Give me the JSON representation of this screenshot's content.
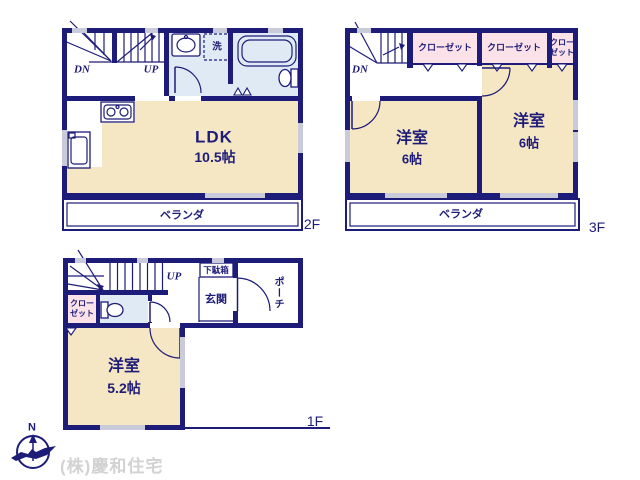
{
  "colors": {
    "wall_navy": "#1d1c78",
    "room_cream": "#f6e7c4",
    "closet_pink": "#fbe2e8",
    "wet_area_blue": "#dfeaf5",
    "window_gray": "#c9cbdb",
    "footer_text_gray": "#d2d2d2"
  },
  "floor2": {
    "label": "2F",
    "stairs_down": "DN",
    "stairs_up": "UP",
    "laundry": "洗",
    "room_name": "LDK",
    "room_size": "10.5帖",
    "veranda": "ベランダ"
  },
  "floor3": {
    "label": "3F",
    "stairs_down": "DN",
    "closet_left": "クローゼット",
    "closet_mid": "クローゼット",
    "closet_small_l1": "クロー",
    "closet_small_l2": "ゼット",
    "room_left_name": "洋室",
    "room_left_size": "6帖",
    "room_right_name": "洋室",
    "room_right_size": "6帖",
    "veranda": "ベランダ"
  },
  "floor1": {
    "label": "1F",
    "stairs_up": "UP",
    "closet_l1": "クロー",
    "closet_l2": "ゼット",
    "shoe_box": "下駄箱",
    "entrance": "玄関",
    "porch": "ポーチ",
    "room_name": "洋室",
    "room_size": "5.2帖"
  },
  "footer": {
    "compass_north": "N",
    "company": "(株)慶和住宅"
  }
}
